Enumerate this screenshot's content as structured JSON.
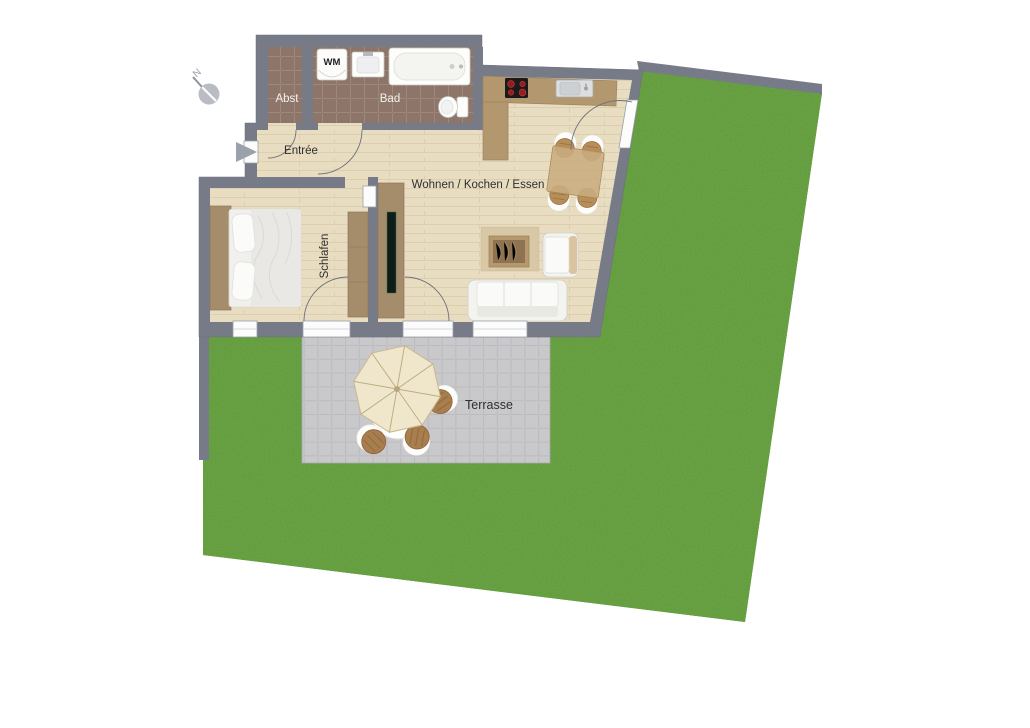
{
  "labels": {
    "storage": "Abst",
    "bathroom": "Bad",
    "washing_machine": "WM",
    "entry": "Entrée",
    "living_kitchen_dining": "Wohnen / Kochen / Essen",
    "bedroom": "Schlafen",
    "terrace": "Terrasse",
    "compass_north": "N"
  },
  "colors": {
    "wall": "#767b87",
    "lawn": "#5b9a33",
    "wood_floor": "#e9ddc1",
    "bath_tile": "#8d7569",
    "terrace_paving": "#c9c9cc",
    "kitchen_counter": "#b3986f",
    "furniture_wood": "#a58c6b",
    "background": "#ffffff"
  }
}
